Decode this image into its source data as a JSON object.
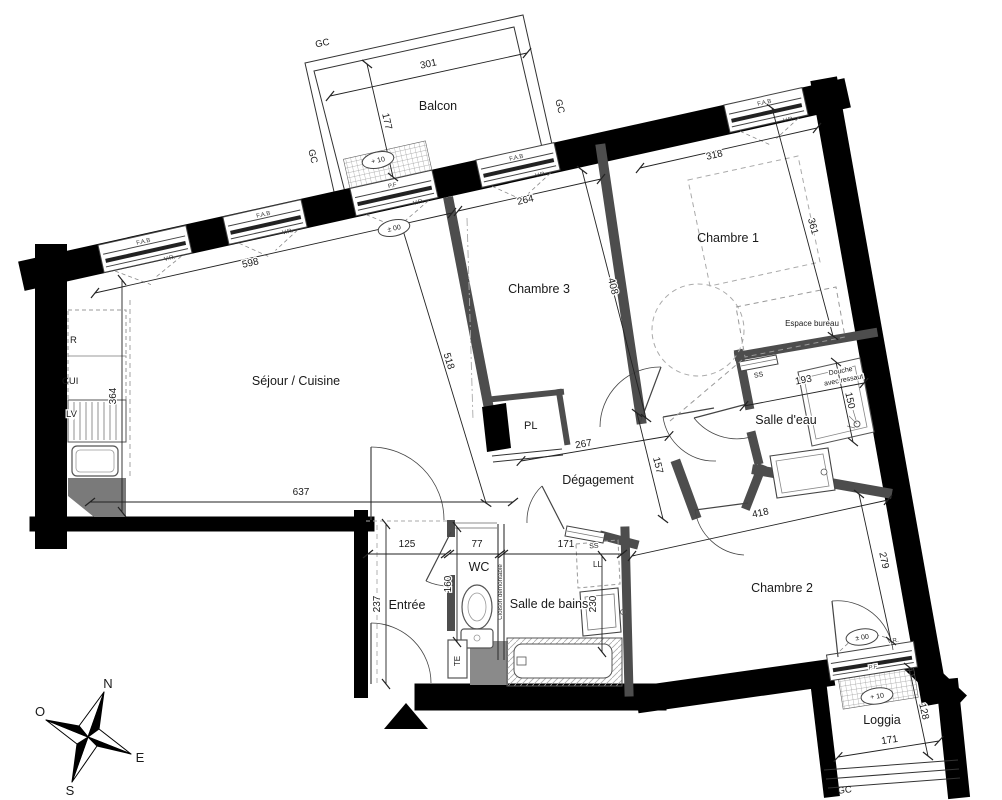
{
  "plan": {
    "rooms": {
      "balcon": "Balcon",
      "sejour": "Séjour / Cuisine",
      "chambre1": "Chambre 1",
      "chambre2": "Chambre 2",
      "chambre3": "Chambre 3",
      "salle_eau": "Salle d'eau",
      "salle_bains": "Salle de bains",
      "degagement": "Dégagement",
      "entree": "Entrée",
      "wc": "WC",
      "loggia": "Loggia",
      "espace_bureau": "Espace bureau"
    },
    "dims": {
      "balcon_w": "301",
      "balcon_d": "177",
      "sejour_top": "598",
      "ch3_w": "264",
      "ch1_w": "318",
      "ch1_d": "361",
      "ch3_d": "408",
      "sejour_ch3": "518",
      "sejour_left": "364",
      "sejour_bottom": "637",
      "salle_eau_w": "193",
      "douche": "150",
      "deg_w": "267",
      "deg_d": "157",
      "ch2_w": "418",
      "ch2_d": "279",
      "entree_w": "125",
      "wc_w": "77",
      "sdb_w": "171",
      "entree_d": "237",
      "wc_d": "160",
      "vasque": "230",
      "loggia_w": "171",
      "loggia_d": "128"
    },
    "ann": {
      "gc": "GC",
      "fab": "F.A.B",
      "vr": "V.R.",
      "pf": "P.F",
      "plus10": "+ 10",
      "pm00": "± 00",
      "r": "R",
      "cui": "CUI",
      "lv": "LV",
      "pl": "PL",
      "ss": "SS",
      "ll": "LL",
      "te": "TE",
      "cloison": "Cloison démontable",
      "douche_l1": "Douche",
      "douche_l2": "avec ressaut"
    },
    "compass": {
      "n": "N",
      "s": "S",
      "e": "E",
      "o": "O"
    }
  }
}
